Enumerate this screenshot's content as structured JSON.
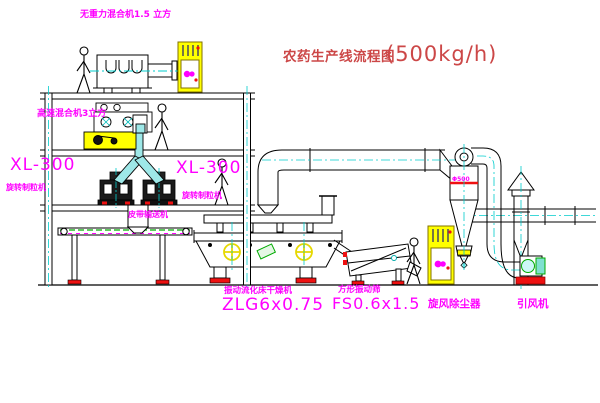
{
  "title": {
    "text": "农药生产线流程图",
    "capacity": "(500kg/h)"
  },
  "labels": {
    "gravity_mixer": "无重力混合机1.5 立方",
    "high_speed_mixer": "高速混合机3立方",
    "granulator_left": {
      "model": "XL-300",
      "name": "旋转制粒机"
    },
    "granulator_right": {
      "model": "XL-300",
      "name": "旋转制粒机"
    },
    "belt_conveyor": "皮带输送机",
    "dryer": {
      "name": "振动流化床干燥机",
      "model": "ZLG6x0.75"
    },
    "sieve": {
      "name": "方形振动筛",
      "model": "FS0.6x1.5"
    },
    "cyclone": "旋风除尘器",
    "cyclone_size": "Φ500",
    "fan": "引风机"
  },
  "colors": {
    "label_magenta": "#ff00ff",
    "title_red": "#cc4747",
    "line_black": "#000000",
    "centerline_cyan": "#00cccc",
    "highlight_yellow": "#ffff00",
    "accent_green": "#00aa00",
    "accent_red": "#ee1111"
  }
}
